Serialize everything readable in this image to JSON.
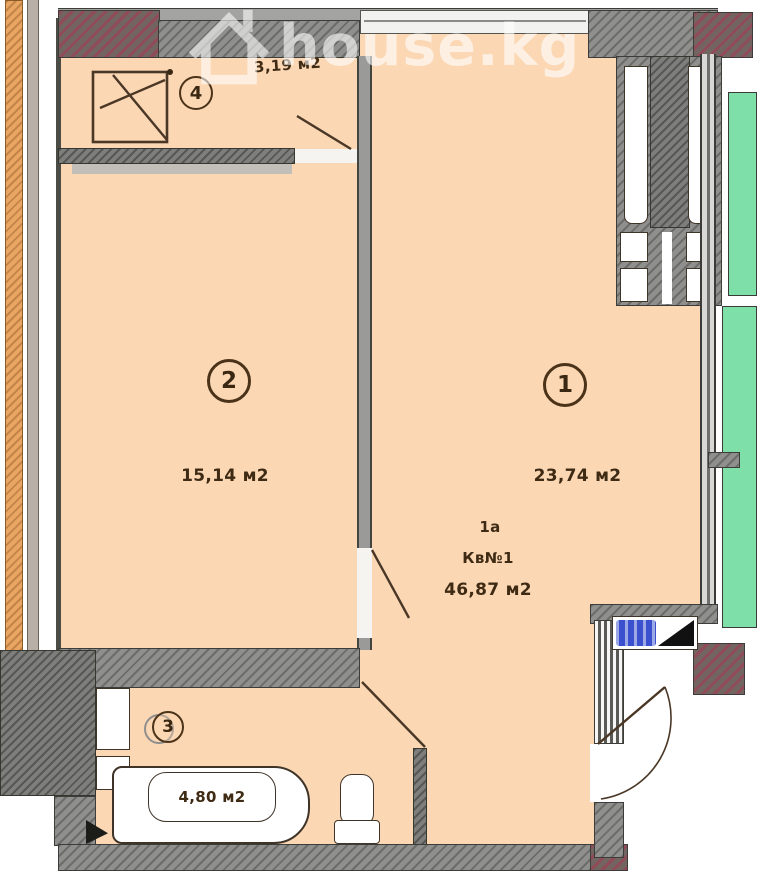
{
  "watermark": {
    "site": "house.kg"
  },
  "apartment": {
    "unit_type": "1а",
    "unit_number": "Кв№1",
    "total_area": "46,87 м2"
  },
  "rooms": {
    "room1": {
      "number": "1",
      "area": "23,74 м2"
    },
    "room2": {
      "number": "2",
      "area": "15,14 м2"
    },
    "room3": {
      "number": "3",
      "area": "4,80 м2"
    },
    "room4": {
      "number": "4",
      "area": "3,19 м2"
    }
  },
  "colors": {
    "room_fill": "#fbd7b4",
    "wall_gray": "#8f8f8d",
    "column_red": "#97766f",
    "neighbor_green": "#7fdfa9",
    "exterior_strip_orange": "#e9a662",
    "marker_blue": "#3a50cf",
    "label_text": "#3f2b14"
  }
}
